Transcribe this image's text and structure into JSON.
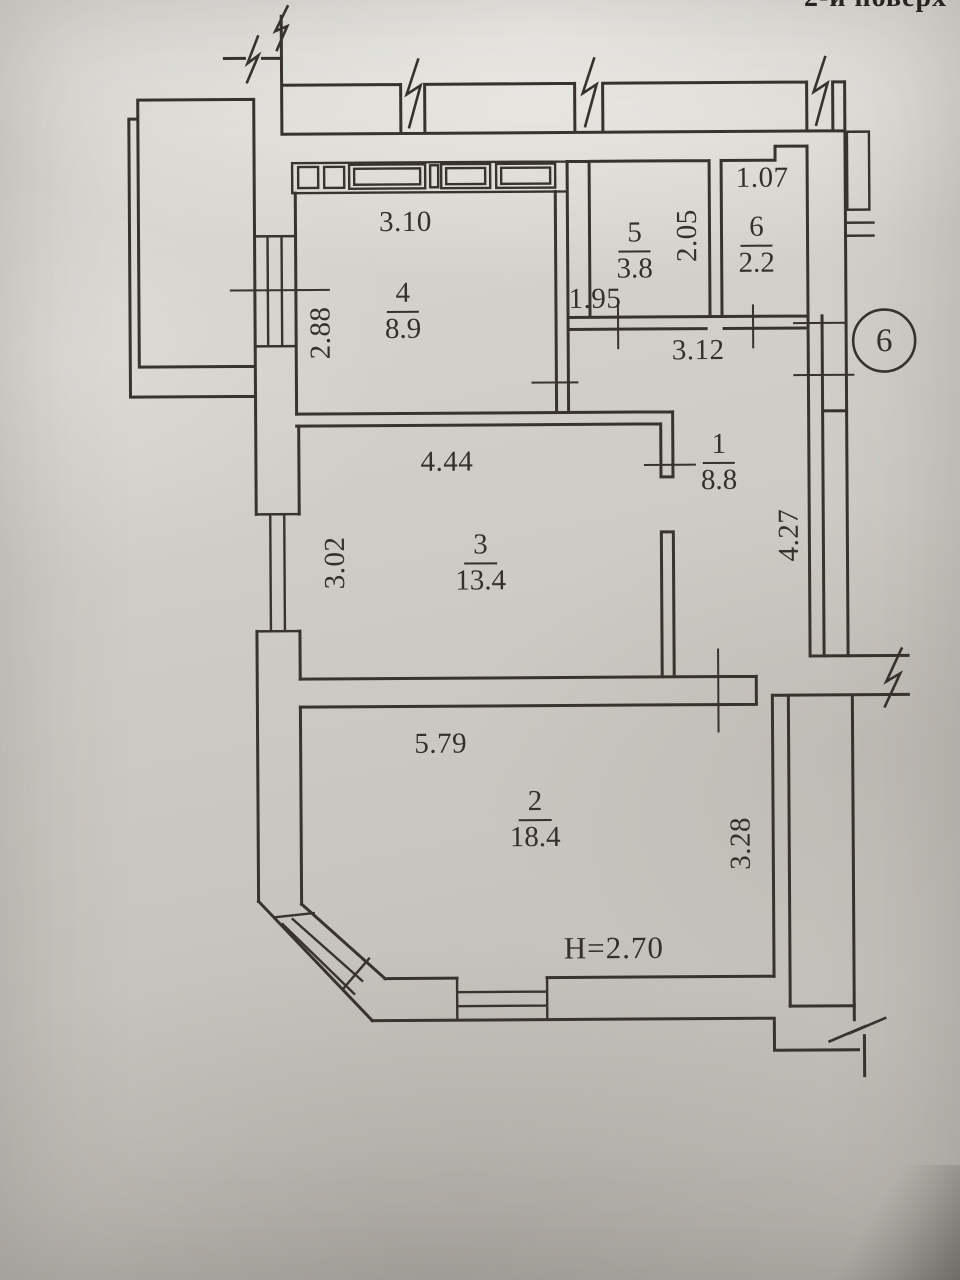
{
  "photo": {
    "caption_top_right": "2-й поверх"
  },
  "colors": {
    "ink": "#35302a",
    "paper": "#ccc9c2"
  },
  "plan": {
    "axis_marker": "6",
    "height_note": "H=2.70",
    "rooms": {
      "r1": {
        "number": "1",
        "area": "8.8"
      },
      "r2": {
        "number": "2",
        "area": "18.4"
      },
      "r3": {
        "number": "3",
        "area": "13.4"
      },
      "r4": {
        "number": "4",
        "area": "8.9"
      },
      "r5": {
        "number": "5",
        "area": "3.8"
      },
      "r6": {
        "number": "6",
        "area": "2.2"
      }
    },
    "dimensions": {
      "room4_width": "3.10",
      "left_wall_window": "2.88",
      "room5_depth": "2.05",
      "room5_door": "1.95",
      "room6_width": "1.07",
      "hallway_width": "3.12",
      "room3_width": "4.44",
      "room3_window": "3.02",
      "hallway_depth": "4.27",
      "room2_width": "5.79",
      "room2_depth": "3.28"
    }
  }
}
